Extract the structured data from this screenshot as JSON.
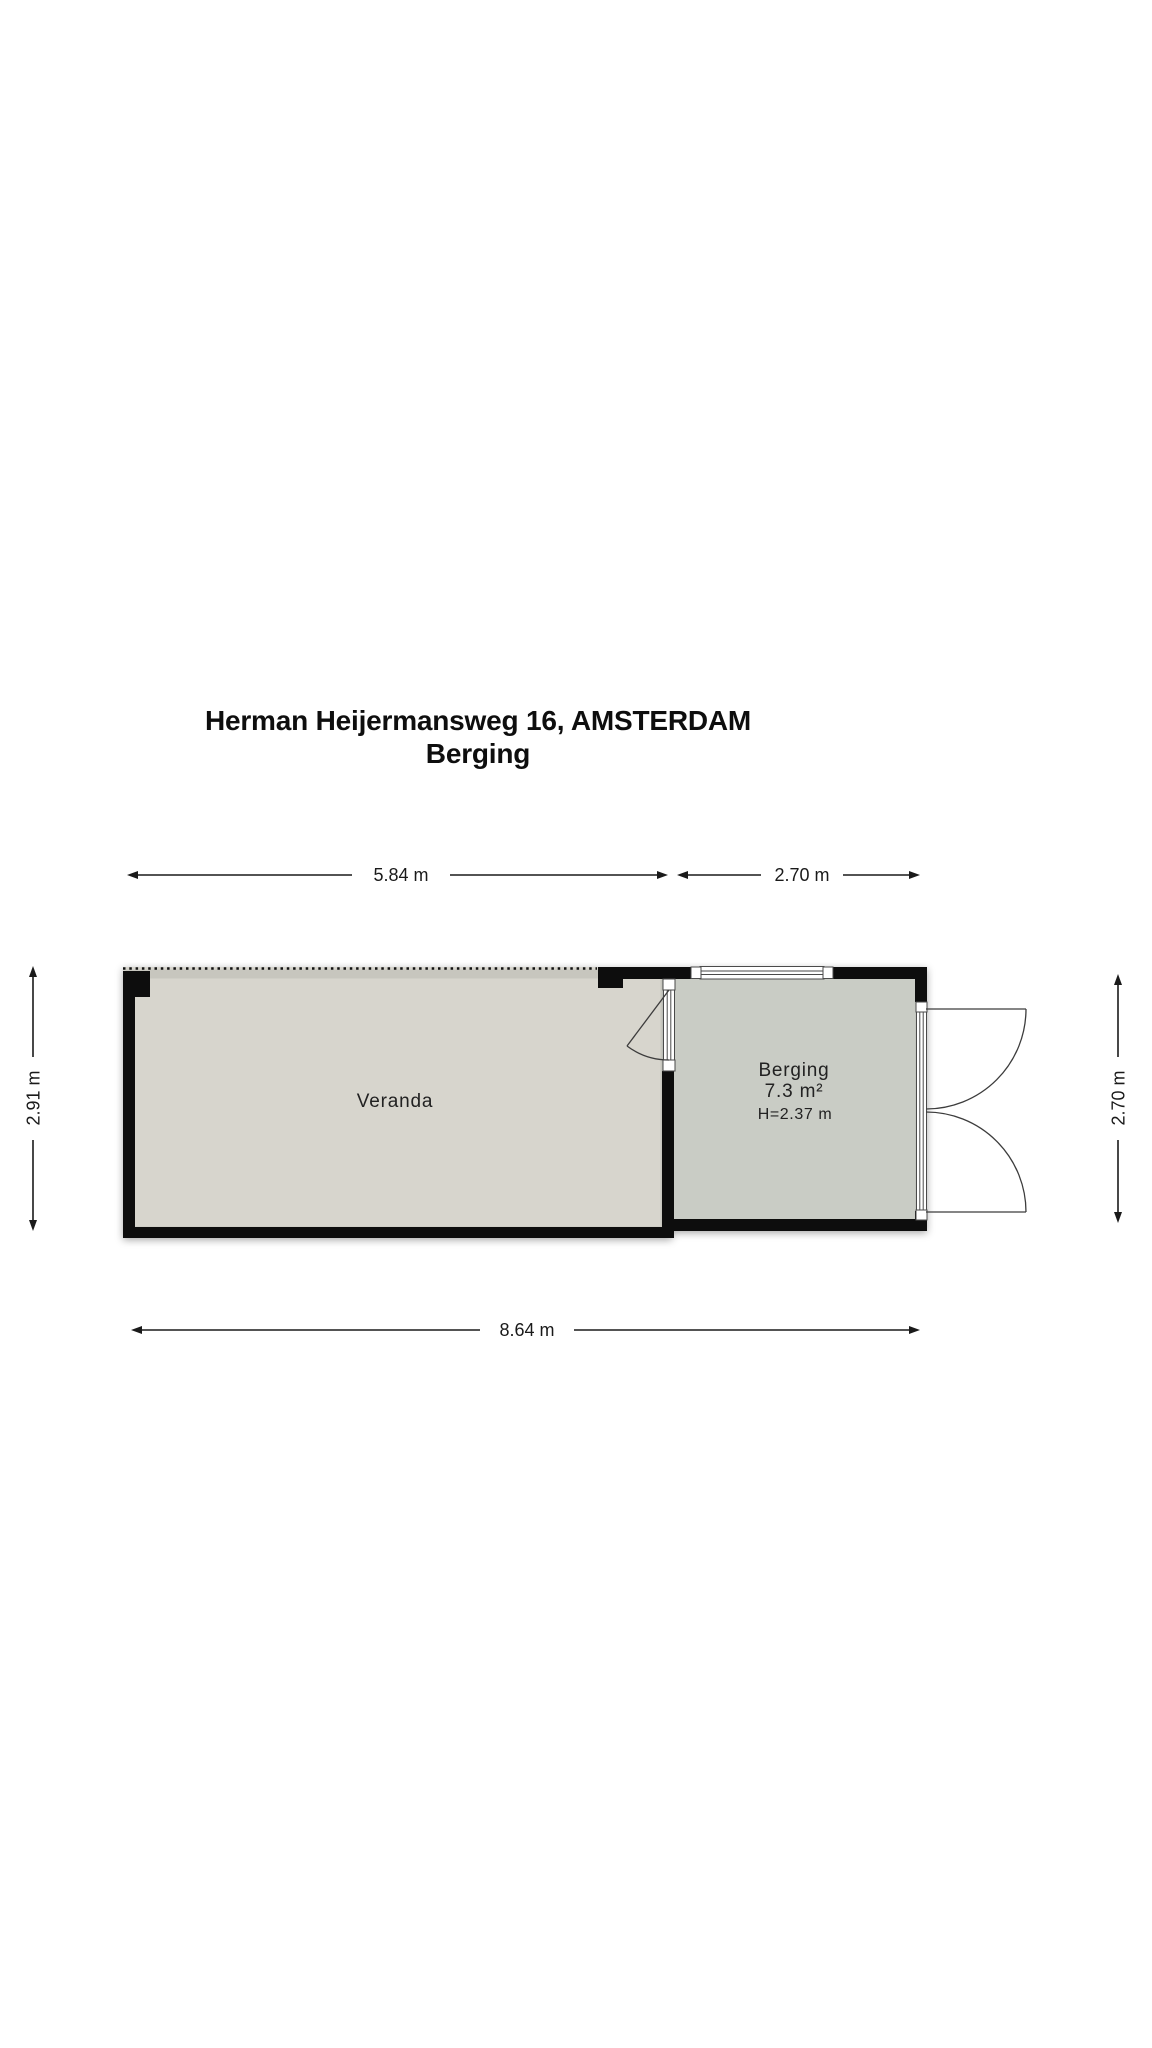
{
  "title": {
    "line1": "Herman Heijermansweg 16, AMSTERDAM",
    "line2": "Berging"
  },
  "dimensions": {
    "top_veranda": "5.84 m",
    "top_berging": "2.70 m",
    "left_veranda": "2.91 m",
    "right_berging": "2.70 m",
    "bottom_total": "8.64 m"
  },
  "rooms": {
    "veranda": {
      "label": "Veranda"
    },
    "berging": {
      "label": "Berging",
      "area": "7.3 m²",
      "ceiling_height": "H=2.37 m"
    }
  },
  "colors": {
    "wall": "#0d0d0d",
    "veranda_fill": "#d7d5cd",
    "berging_fill": "#c9ccc5",
    "dimension_ink": "#1a1a1a",
    "door_ink": "#3c3c3c"
  }
}
